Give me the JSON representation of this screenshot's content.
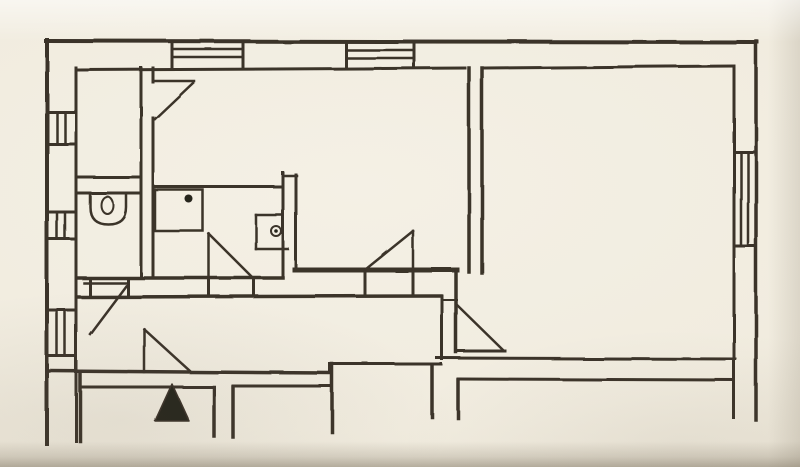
{
  "canvas": {
    "width": 800,
    "height": 467
  },
  "palette": {
    "paper": "#f1ecdf",
    "paper_shadow": "#7c7260",
    "ink": "#2e251c",
    "ink_fill": "#17120d"
  },
  "floorplan": {
    "walls": [
      {
        "n": "outer-wall-top",
        "t": "l",
        "p": [
          46,
          41,
          757,
          42
        ],
        "w": 4
      },
      {
        "n": "outer-wall-left",
        "t": "l",
        "p": [
          47,
          40,
          47,
          444
        ],
        "w": 4
      },
      {
        "n": "outer-wall-right",
        "t": "l",
        "p": [
          756,
          41,
          756,
          420
        ],
        "w": 3.5
      },
      {
        "n": "inner-wall-right",
        "t": "l",
        "p": [
          734,
          68,
          734,
          418
        ],
        "w": 3
      },
      {
        "n": "inner-wall-top-left-span",
        "t": "l",
        "p": [
          78,
          70,
          465,
          68
        ],
        "w": 3
      },
      {
        "n": "inner-wall-top-right-span",
        "t": "l",
        "p": [
          485,
          68,
          734,
          66
        ],
        "w": 3
      },
      {
        "n": "inner-wall-left",
        "t": "l",
        "p": [
          76,
          68,
          76,
          441
        ],
        "w": 3
      },
      {
        "n": "closet-right-wall",
        "t": "l",
        "p": [
          141,
          68,
          141,
          278
        ],
        "w": 3
      },
      {
        "n": "living-left-wall-upper",
        "t": "l",
        "p": [
          153,
          68,
          153,
          82
        ],
        "w": 3
      },
      {
        "n": "living-left-wall-lower",
        "t": "l",
        "p": [
          153,
          118,
          153,
          278
        ],
        "w": 3
      },
      {
        "n": "closet-bottom-wall",
        "t": "l",
        "p": [
          78,
          177,
          141,
          177
        ],
        "w": 3
      },
      {
        "n": "wc-top-wall",
        "t": "l",
        "p": [
          78,
          193,
          141,
          193
        ],
        "w": 3
      },
      {
        "n": "bath-top-wall",
        "t": "l",
        "p": [
          153,
          187,
          283,
          187
        ],
        "w": 3
      },
      {
        "n": "bath-right-wall",
        "t": "l",
        "p": [
          283,
          173,
          283,
          278
        ],
        "w": 3
      },
      {
        "n": "bath-living-link-wall",
        "t": "l",
        "p": [
          283,
          176,
          297,
          176
        ],
        "w": 2.5
      },
      {
        "n": "bath-bottom-wall",
        "t": "l",
        "p": [
          78,
          278,
          283,
          278
        ],
        "w": 3.5
      },
      {
        "n": "living-left-wall",
        "t": "l",
        "p": [
          296,
          175,
          296,
          268
        ],
        "w": 3
      },
      {
        "n": "living-bottom-wall",
        "t": "l",
        "p": [
          295,
          270,
          457,
          270
        ],
        "w": 5
      },
      {
        "n": "living-right-wall-inner",
        "t": "l",
        "p": [
          469,
          68,
          469,
          272
        ],
        "w": 3.5
      },
      {
        "n": "living-right-wall-outer",
        "t": "l",
        "p": [
          482,
          68,
          482,
          273
        ],
        "w": 3.5
      },
      {
        "n": "right-room-lower-left-wall",
        "t": "l",
        "p": [
          456,
          272,
          456,
          352
        ],
        "w": 3.5
      },
      {
        "n": "right-room-bottom-wall",
        "t": "l",
        "p": [
          437,
          358,
          735,
          359
        ],
        "w": 3
      },
      {
        "n": "bottom-right-room-top-wall",
        "t": "l",
        "p": [
          458,
          379,
          734,
          380
        ],
        "w": 3
      },
      {
        "n": "corridor-top-wall",
        "t": "l",
        "p": [
          78,
          297,
          441,
          296
        ],
        "w": 3.5
      },
      {
        "n": "corridor-end-wall",
        "t": "l",
        "p": [
          442,
          296,
          442,
          359
        ],
        "w": 3
      },
      {
        "n": "corridor-bottom-wall-west",
        "t": "l",
        "p": [
          48,
          371,
          330,
          373
        ],
        "w": 3.5
      },
      {
        "n": "corridor-bottom-step",
        "t": "l",
        "p": [
          330,
          364,
          330,
          373
        ],
        "w": 3
      },
      {
        "n": "corridor-bottom-wall-east",
        "t": "l",
        "p": [
          330,
          364,
          441,
          364
        ],
        "w": 3
      },
      {
        "n": "right-door-lintel-tick",
        "t": "l",
        "p": [
          443,
          300,
          457,
          300
        ],
        "w": 2
      },
      {
        "n": "living-door-jamb-left",
        "t": "l",
        "p": [
          365,
          272,
          365,
          294
        ],
        "w": 3
      },
      {
        "n": "living-door-jamb-right",
        "t": "l",
        "p": [
          413,
          272,
          413,
          294
        ],
        "w": 3
      },
      {
        "n": "wc-door-jamb-left",
        "t": "l",
        "p": [
          90,
          278,
          90,
          297
        ],
        "w": 3
      },
      {
        "n": "wc-door-jamb-right",
        "t": "l",
        "p": [
          128,
          278,
          128,
          297
        ],
        "w": 3
      },
      {
        "n": "bath-door-jamb-left",
        "t": "l",
        "p": [
          209,
          278,
          209,
          295
        ],
        "w": 3
      },
      {
        "n": "bath-door-jamb-right",
        "t": "l",
        "p": [
          254,
          278,
          254,
          295
        ],
        "w": 3
      },
      {
        "n": "bottom-room-left-wall",
        "t": "l",
        "p": [
          80,
          373,
          80,
          441
        ],
        "w": 3.5
      },
      {
        "n": "bottom-room-top-wall-1",
        "t": "l",
        "p": [
          80,
          387,
          213,
          387
        ],
        "w": 3
      },
      {
        "n": "bottom-wall-stub-a",
        "t": "l",
        "p": [
          214,
          387,
          214,
          436
        ],
        "w": 3.5
      },
      {
        "n": "bottom-wall-stub-b",
        "t": "l",
        "p": [
          233,
          387,
          233,
          437
        ],
        "w": 3.5
      },
      {
        "n": "bottom-room-top-wall-2",
        "t": "l",
        "p": [
          233,
          386,
          330,
          386
        ],
        "w": 3
      },
      {
        "n": "bottom-wall-stub-c",
        "t": "l",
        "p": [
          332,
          364,
          332,
          432
        ],
        "w": 3.5
      },
      {
        "n": "bottom-wall-stub-d",
        "t": "l",
        "p": [
          432,
          366,
          432,
          417
        ],
        "w": 3.5
      },
      {
        "n": "bottom-wall-stub-e",
        "t": "l",
        "p": [
          458,
          380,
          458,
          418
        ],
        "w": 3.5
      }
    ],
    "windows": [
      {
        "n": "top-window-1-left-edge",
        "t": "l",
        "p": [
          172,
          42,
          172,
          68
        ],
        "w": 3
      },
      {
        "n": "top-window-1-right-edge",
        "t": "l",
        "p": [
          243,
          42,
          243,
          68
        ],
        "w": 3
      },
      {
        "n": "top-window-1-hatch-1",
        "t": "l",
        "p": [
          172,
          49,
          243,
          49
        ],
        "w": 2.5
      },
      {
        "n": "top-window-1-hatch-2",
        "t": "l",
        "p": [
          172,
          57,
          243,
          57
        ],
        "w": 2.5
      },
      {
        "n": "top-window-2-left-edge",
        "t": "l",
        "p": [
          346,
          42,
          346,
          67
        ],
        "w": 3
      },
      {
        "n": "top-window-2-right-edge",
        "t": "l",
        "p": [
          414,
          42,
          414,
          67
        ],
        "w": 3
      },
      {
        "n": "top-window-2-hatch-1",
        "t": "l",
        "p": [
          346,
          50,
          414,
          50
        ],
        "w": 2.5
      },
      {
        "n": "top-window-2-hatch-2",
        "t": "l",
        "p": [
          346,
          58,
          414,
          58
        ],
        "w": 2.5
      },
      {
        "n": "right-window-top-cap",
        "t": "l",
        "p": [
          734,
          152,
          756,
          152
        ],
        "w": 3
      },
      {
        "n": "right-window-bottom-cap",
        "t": "l",
        "p": [
          734,
          246,
          756,
          246
        ],
        "w": 3
      },
      {
        "n": "right-window-hatch-1",
        "t": "l",
        "p": [
          741,
          152,
          741,
          246
        ],
        "w": 2.5
      },
      {
        "n": "right-window-hatch-2",
        "t": "l",
        "p": [
          748,
          152,
          748,
          246
        ],
        "w": 2.5
      },
      {
        "n": "left-window-1-top-cap",
        "t": "l",
        "p": [
          47,
          112,
          74,
          112
        ],
        "w": 3
      },
      {
        "n": "left-window-1-bottom-cap",
        "t": "l",
        "p": [
          47,
          144,
          74,
          144
        ],
        "w": 3
      },
      {
        "n": "left-window-1-hatch-1",
        "t": "l",
        "p": [
          57,
          112,
          57,
          144
        ],
        "w": 2.5
      },
      {
        "n": "left-window-1-hatch-2",
        "t": "l",
        "p": [
          65,
          112,
          65,
          144
        ],
        "w": 2.5
      },
      {
        "n": "left-window-2-top-cap",
        "t": "l",
        "p": [
          47,
          212,
          74,
          212
        ],
        "w": 3
      },
      {
        "n": "left-window-2-bottom-cap",
        "t": "l",
        "p": [
          47,
          239,
          74,
          239
        ],
        "w": 3
      },
      {
        "n": "left-window-2-hatch-1",
        "t": "l",
        "p": [
          57,
          212,
          57,
          239
        ],
        "w": 2.5
      },
      {
        "n": "left-window-2-hatch-2",
        "t": "l",
        "p": [
          65,
          212,
          65,
          239
        ],
        "w": 2.5
      },
      {
        "n": "left-window-3-top-cap",
        "t": "l",
        "p": [
          47,
          310,
          74,
          310
        ],
        "w": 3
      },
      {
        "n": "left-window-3-bottom-cap",
        "t": "l",
        "p": [
          47,
          356,
          74,
          356
        ],
        "w": 3
      },
      {
        "n": "left-window-3-hatch-1",
        "t": "l",
        "p": [
          57,
          310,
          57,
          356
        ],
        "w": 2.5
      },
      {
        "n": "left-window-3-hatch-2",
        "t": "l",
        "p": [
          65,
          310,
          65,
          356
        ],
        "w": 2.5
      }
    ],
    "doors": [
      {
        "n": "closet-door-leaf",
        "t": "l",
        "p": [
          153,
          81,
          194,
          81
        ],
        "w": 2.5
      },
      {
        "n": "closet-door-swing",
        "t": "l",
        "p": [
          193,
          83,
          155,
          119
        ],
        "w": 2.5
      },
      {
        "n": "wc-door-leaf",
        "t": "l",
        "p": [
          84,
          283,
          127,
          283
        ],
        "w": 2.5
      },
      {
        "n": "wc-door-swing",
        "t": "l",
        "p": [
          126,
          286,
          90,
          334
        ],
        "w": 2.5
      },
      {
        "n": "bath-door-leaf",
        "t": "l",
        "p": [
          209,
          234,
          209,
          277
        ],
        "w": 2.5
      },
      {
        "n": "bath-door-swing",
        "t": "l",
        "p": [
          209,
          234,
          252,
          277
        ],
        "w": 2.5
      },
      {
        "n": "living-door-leaf",
        "t": "l",
        "p": [
          413,
          231,
          413,
          269
        ],
        "w": 2.5
      },
      {
        "n": "living-door-swing",
        "t": "l",
        "p": [
          413,
          231,
          366,
          269
        ],
        "w": 2.5
      },
      {
        "n": "entrance-door-leaf",
        "t": "l",
        "p": [
          144,
          329,
          144,
          372
        ],
        "w": 2.5
      },
      {
        "n": "entrance-door-swing",
        "t": "l",
        "p": [
          144,
          329,
          191,
          372
        ],
        "w": 2.5
      },
      {
        "n": "right-room-door-base",
        "t": "l",
        "p": [
          456,
          351,
          505,
          351
        ],
        "w": 3
      },
      {
        "n": "right-room-door-swing",
        "t": "l",
        "p": [
          456,
          304,
          503,
          350
        ],
        "w": 2.5
      }
    ],
    "fixtures": [
      {
        "n": "toilet-bowl-outline",
        "t": "path",
        "p": "M 90 193 L 126 193 L 126 207 Q 126 224 108 224 Q 90 224 90 207 Z",
        "w": 2.5
      },
      {
        "n": "toilet-seat-ellipse",
        "t": "e",
        "p": [
          107,
          205,
          6,
          8.5
        ],
        "w": 2
      },
      {
        "n": "shower-tray",
        "t": "r",
        "p": [
          155,
          190,
          48,
          41
        ],
        "w": 2.5
      },
      {
        "n": "shower-drain-dot",
        "t": "cf",
        "p": [
          189,
          199,
          4
        ]
      },
      {
        "n": "basin-top-edge",
        "t": "l",
        "p": [
          256,
          215,
          283,
          215
        ],
        "w": 2.5
      },
      {
        "n": "basin-left-edge",
        "t": "l",
        "p": [
          256,
          215,
          256,
          249
        ],
        "w": 2.5
      },
      {
        "n": "basin-bottom-edge",
        "t": "l",
        "p": [
          256,
          249,
          288,
          249
        ],
        "w": 2.5
      },
      {
        "n": "basin-drain-ring",
        "t": "c",
        "p": [
          276,
          231,
          5
        ],
        "w": 2
      },
      {
        "n": "basin-drain-dot",
        "t": "cf",
        "p": [
          276,
          231,
          1.8
        ]
      }
    ],
    "markers": [
      {
        "n": "entrance-arrow",
        "t": "poly",
        "p": [
          [
            172,
            384
          ],
          [
            155,
            421
          ],
          [
            189,
            421
          ]
        ]
      }
    ]
  }
}
